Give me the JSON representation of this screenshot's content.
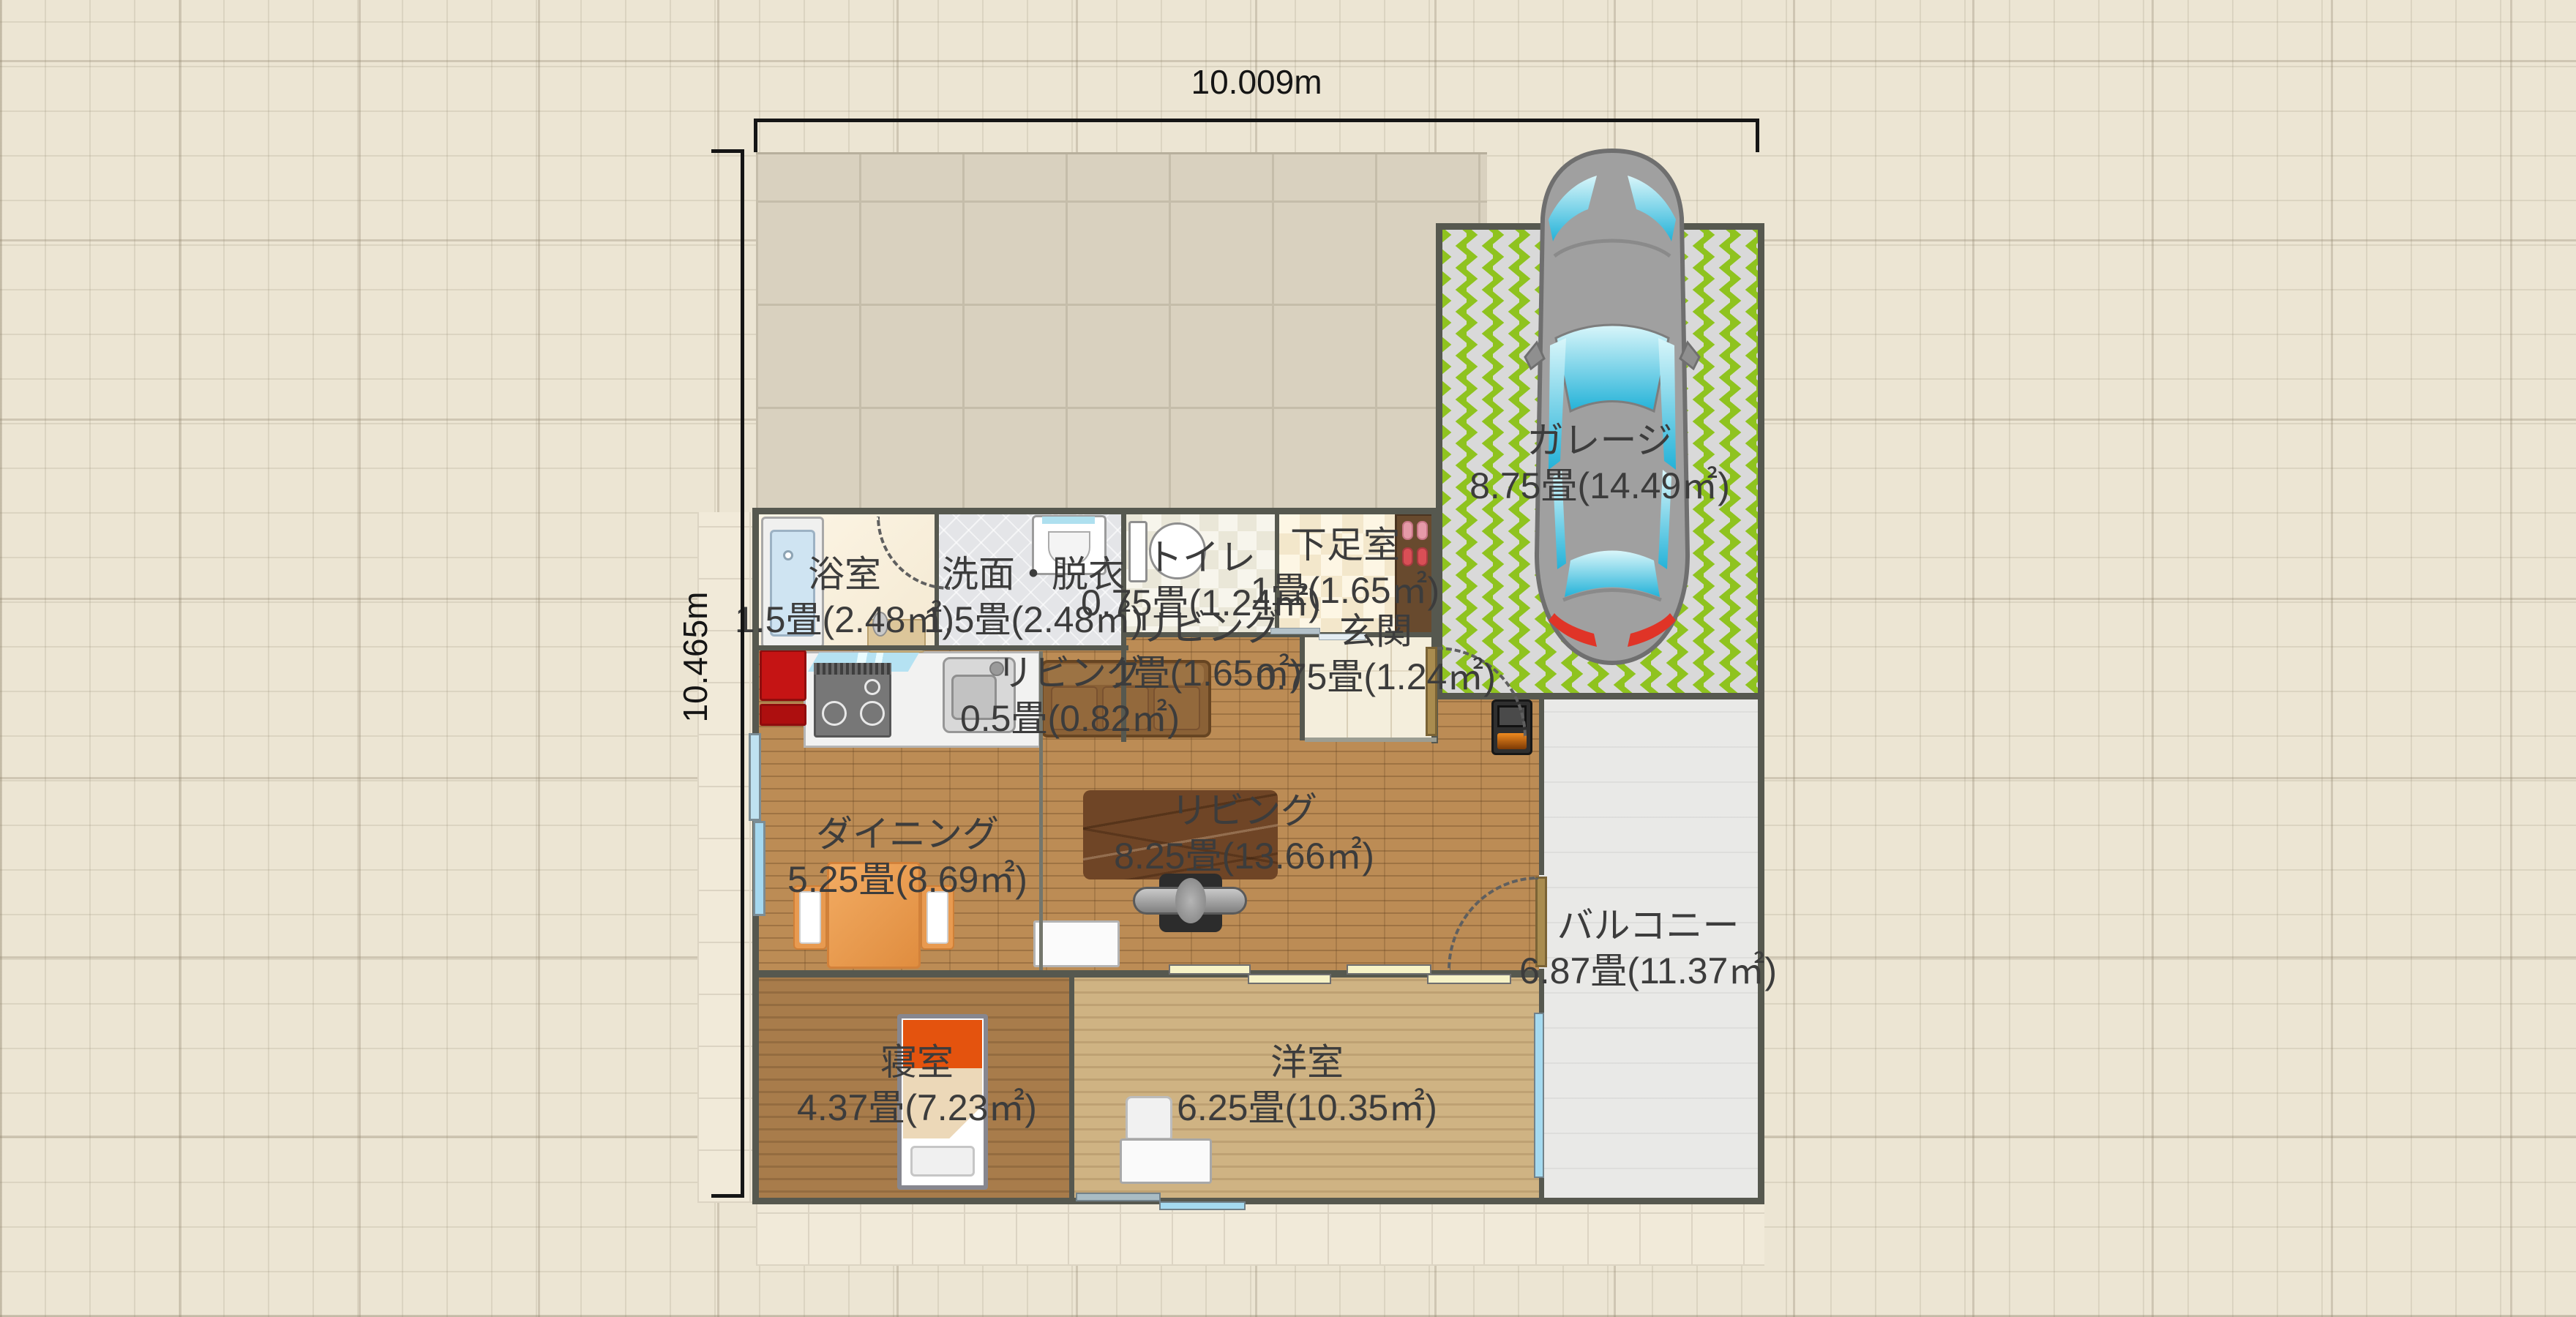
{
  "dimensions": {
    "width_label": "10.009m",
    "height_label": "10.465m"
  },
  "rooms": {
    "garage": {
      "name": "ガレージ",
      "area": "8.75畳(14.49㎡)"
    },
    "bathroom": {
      "name": "浴室",
      "area": "1.5畳(2.48㎡)"
    },
    "washroom": {
      "name": "洗面・脱衣",
      "area": "1.5畳(2.48㎡)"
    },
    "toilet": {
      "name": "トイレ",
      "area": "0.75畳(1.24㎡)"
    },
    "shoe_room": {
      "name": "下足室",
      "area": "1畳(1.65㎡)"
    },
    "entrance": {
      "name": "玄関",
      "area": "0.75畳(1.24㎡)"
    },
    "living_hall": {
      "name": "リビング",
      "area": "1畳(1.65㎡)"
    },
    "living_nook": {
      "name": "リビング",
      "area": "0.5畳(0.82㎡)"
    },
    "dining": {
      "name": "ダイニング",
      "area": "5.25畳(8.69㎡)"
    },
    "living": {
      "name": "リビング",
      "area": "8.25畳(13.66㎡)"
    },
    "balcony": {
      "name": "バルコニー",
      "area": "6.87畳(11.37㎡)"
    },
    "bedroom": {
      "name": "寝室",
      "area": "4.37畳(7.23㎡)"
    },
    "western_room": {
      "name": "洋室",
      "area": "6.25畳(10.35㎡)"
    }
  },
  "colors": {
    "canvas": "#ece5d3",
    "yard_tile": "#d9d1bf",
    "wall": "#56584f",
    "brick_floor": "#bc8c55",
    "garage_green": "#8fc31f",
    "garage_gray": "#d9d9d9",
    "balcony": "#e9e9e7",
    "fridge_red": "#c51414",
    "bed_pillow": "#e4530e",
    "table_orange": "#ea9c51",
    "glass_cyan": "#23b2d8"
  }
}
